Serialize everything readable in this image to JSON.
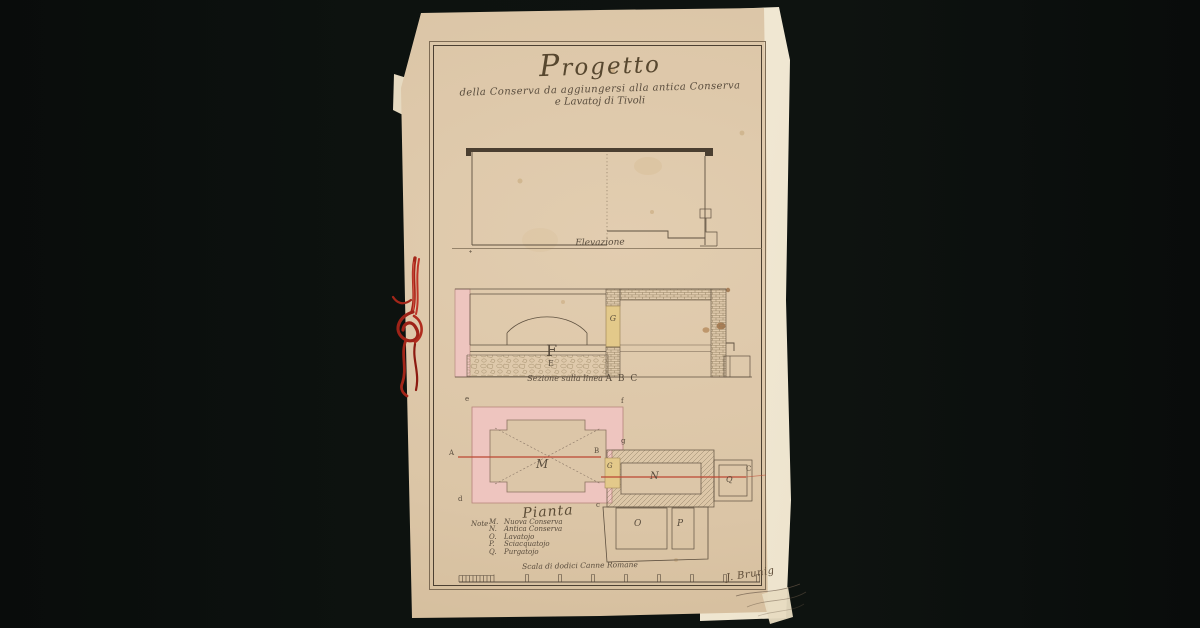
{
  "page": {
    "title": "Progetto",
    "subtitle1": "della Conserva da aggiungersi alla antica Conserva",
    "subtitle2": "e Lavatoj di Tivoli",
    "signature": "J. Brunig"
  },
  "captions": {
    "elevation": "Elevazione",
    "section_script": "Sezione sulla linea",
    "section_letters": "A B C",
    "plan_title": "Pianta",
    "note": "Note",
    "scale": "Scala di dodici Canne Romane"
  },
  "letters": {
    "A": "A",
    "B": "B",
    "C": "C",
    "E": "E",
    "F": "F",
    "G": "G",
    "M": "M",
    "N": "N",
    "O": "O",
    "P": "P",
    "Q": "Q",
    "c": "c",
    "d": "d",
    "e": "e",
    "f": "f",
    "g": "g"
  },
  "legend": {
    "entries": [
      {
        "key": "M.",
        "text": "Nuova Conserva"
      },
      {
        "key": "N.",
        "text": "Antica Conserva"
      },
      {
        "key": "O.",
        "text": "Lavatojo"
      },
      {
        "key": "P.",
        "text": "Sciacquatojo"
      },
      {
        "key": "Q.",
        "text": "Purgatojo"
      }
    ]
  },
  "colors": {
    "background": "#0b0e0d",
    "paper": "#dbc5a6",
    "backing_sheet": "#ece1cb",
    "ink": "#4e4234",
    "wall_pink": "#eec5bf",
    "door_yellow": "#e3c98a",
    "section_line_red": "#bb4733",
    "binding_cord_red": "#a5241a"
  }
}
